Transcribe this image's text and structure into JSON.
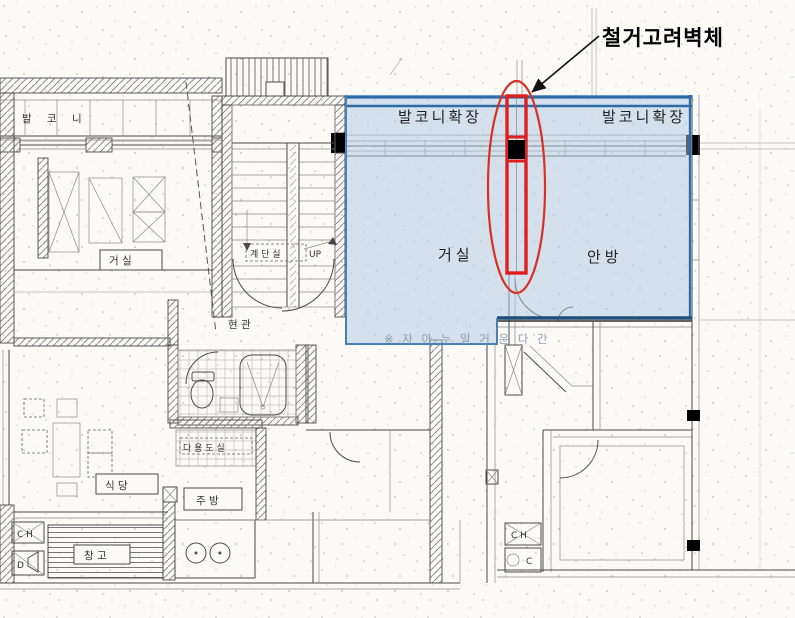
{
  "annotation": {
    "title": "철거고려벽체",
    "meaning": "wall considered for demolition callout with leader arrow"
  },
  "overlay_labels": {
    "balcony_ext_left": "발코니확장",
    "balcony_ext_right": "발코니확장",
    "living": "거실",
    "master_bedroom": "안방",
    "faint_note": "※ 자 아 누 일 거 운 다 간"
  },
  "plan_labels": {
    "stairwell": "계 단 실",
    "up": "UP",
    "entrance": "현 관",
    "left_balcony": "발 코 니",
    "left_living": "거  실",
    "left_dining": "식  당",
    "utility": "다 용 도 실",
    "kitchen": "주  방",
    "storage": "창  고",
    "ch_left": "C H",
    "d_left": "D",
    "ch_right": "C H",
    "c_right": "C"
  },
  "colors": {
    "overlay_fill": "#adc8e4",
    "overlay_border": "#2e6ca8",
    "overlay_border_light": "#4a7fb5",
    "overlay_border_dark": "#1f4e79",
    "highlight_red": "#e01e1e",
    "ellipse_red": "#d93025",
    "column_black": "#000000",
    "drawing_line": "#4a4a4a",
    "paper": "#fbfaf7"
  }
}
